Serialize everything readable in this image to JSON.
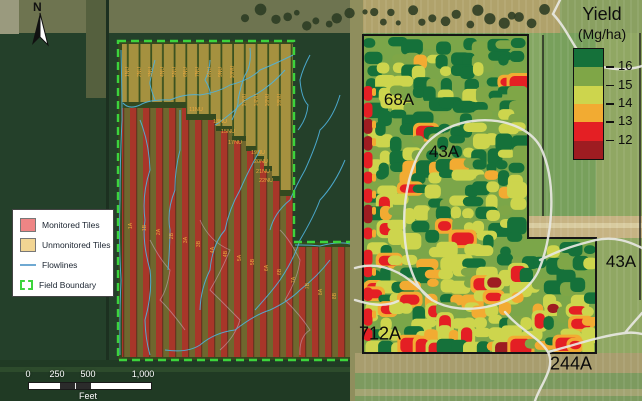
{
  "figure": {
    "type": "two-panel field map",
    "left_panel_description": "aerial map of tile-drained field",
    "right_panel_description": "yield map"
  },
  "left_panel": {
    "north_label": "N",
    "legend": {
      "items": [
        {
          "name": "monitored-tiles",
          "label": "Monitored Tiles",
          "swatch": "#ef8585",
          "type": "fill"
        },
        {
          "name": "unmonitored-tiles",
          "label": "Unmonitored Tiles",
          "swatch": "#f2d593",
          "type": "fill"
        },
        {
          "name": "flowlines",
          "label": "Flowlines",
          "swatch": "#6fa9d2",
          "type": "line"
        },
        {
          "name": "field-boundary",
          "label": "Field Boundary",
          "swatch": "#3cd43c",
          "type": "dashed"
        }
      ]
    },
    "scalebar": {
      "ticks": [
        "0",
        "250",
        "500",
        "1,000"
      ],
      "unit": "Feet"
    },
    "tile_labels": {
      "unmonitored_columns": [
        "1NU",
        "2NU",
        "3NU",
        "4NU",
        "5NU",
        "6NU",
        "7NU",
        "8NU",
        "9NU",
        "10NU",
        "12NU",
        "14NU",
        "16NU",
        "18NU"
      ],
      "unmonitored_rows": [
        "11NU",
        "13NU",
        "15NU",
        "17NU",
        "19NU",
        "20NU",
        "21NU",
        "22NU"
      ],
      "monitored": [
        "1A",
        "1B",
        "2A",
        "2B",
        "3A",
        "3B",
        "4A",
        "4B",
        "5A",
        "5B",
        "6A",
        "6B",
        "7A",
        "7B",
        "8A",
        "8B"
      ]
    }
  },
  "right_panel": {
    "field_labels": [
      {
        "text": "68A",
        "x": 399,
        "y": 100
      },
      {
        "text": "43A",
        "x": 444,
        "y": 152
      },
      {
        "text": "712A",
        "x": 380,
        "y": 334
      },
      {
        "text": "244A",
        "x": 571,
        "y": 364
      },
      {
        "text": "43A",
        "x": 621,
        "y": 262
      }
    ],
    "legend": {
      "title": "Yield",
      "subtitle": "(Mg/ha)",
      "classes": [
        {
          "color": "#15713a"
        },
        {
          "color": "#7fa647"
        },
        {
          "color": "#cdd54d"
        },
        {
          "color": "#f2ab32"
        },
        {
          "color": "#e41f24"
        },
        {
          "color": "#9e1c21"
        }
      ],
      "tick_labels": [
        "16",
        "15",
        "14",
        "13",
        "12"
      ]
    }
  },
  "palette": {
    "boundary_green": "#3cd43c",
    "flowline_blue": "#4fb3dd",
    "white_flowline": "#e8e8e2",
    "stripe_red": "#a83629",
    "stripe_olive": "#6f672e",
    "tile_tan": "#a5913f",
    "yield_base_green": "#7ba649"
  }
}
